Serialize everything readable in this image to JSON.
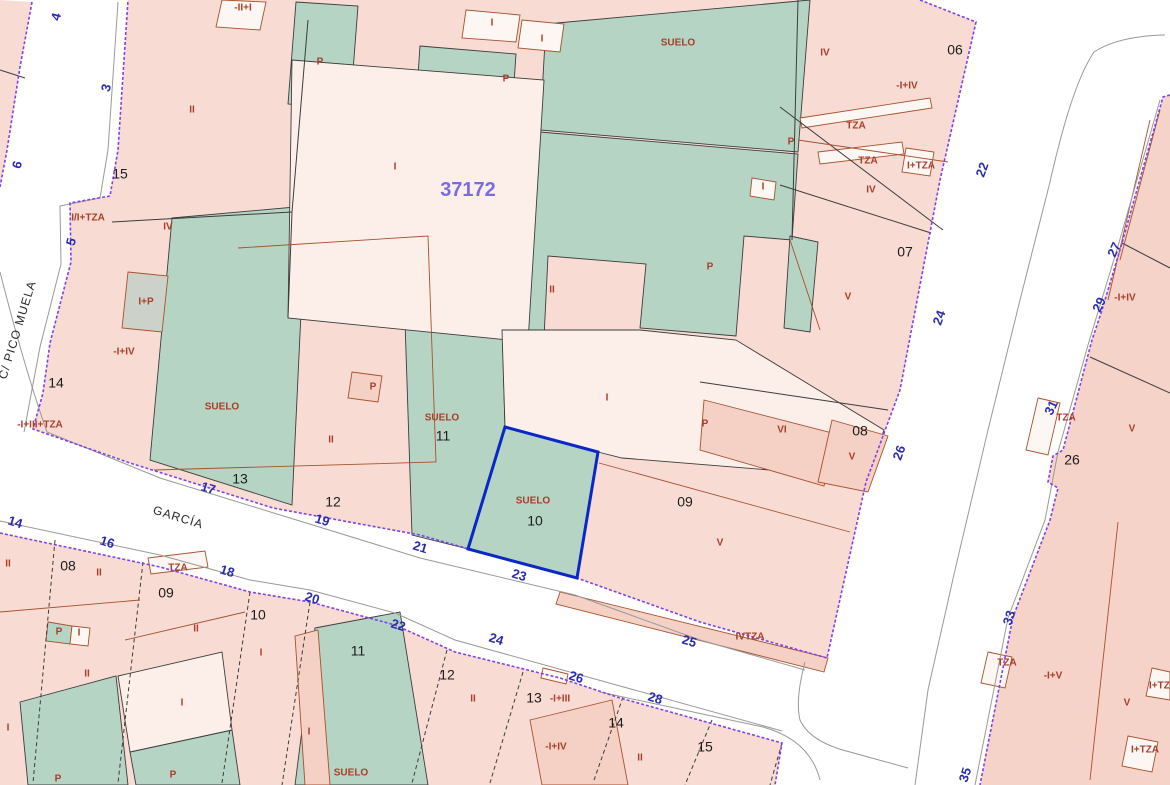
{
  "map": {
    "title": "Cadastral parcel map",
    "block_id": {
      "text": "37172",
      "x": 468,
      "y": 196
    },
    "selected_parcel": {
      "number": "10",
      "use": "SUELO"
    },
    "street_names": [
      {
        "t": "C/ PICO MUELA",
        "x": 18,
        "y": 330,
        "r": -73
      },
      {
        "t": "GARCÍA",
        "x": 178,
        "y": 518,
        "r": 17
      }
    ],
    "street_numbers": [
      {
        "t": "4",
        "x": 57,
        "y": 17,
        "r": -75
      },
      {
        "t": "3",
        "x": 107,
        "y": 88,
        "r": -75
      },
      {
        "t": "6",
        "x": 18,
        "y": 165,
        "r": -75
      },
      {
        "t": "5",
        "x": 72,
        "y": 242,
        "r": -75
      },
      {
        "t": "22",
        "x": 983,
        "y": 170,
        "r": -70
      },
      {
        "t": "24",
        "x": 940,
        "y": 318,
        "r": -70
      },
      {
        "t": "26",
        "x": 900,
        "y": 453,
        "r": -70
      },
      {
        "t": "27",
        "x": 1115,
        "y": 250,
        "r": -65
      },
      {
        "t": "29",
        "x": 1100,
        "y": 305,
        "r": -65
      },
      {
        "t": "31",
        "x": 1052,
        "y": 408,
        "r": -65
      },
      {
        "t": "33",
        "x": 1010,
        "y": 618,
        "r": -72
      },
      {
        "t": "35",
        "x": 966,
        "y": 775,
        "r": -72
      },
      {
        "t": "14",
        "x": 15,
        "y": 523,
        "r": 17
      },
      {
        "t": "16",
        "x": 107,
        "y": 543,
        "r": 17
      },
      {
        "t": "18",
        "x": 227,
        "y": 572,
        "r": 17
      },
      {
        "t": "20",
        "x": 312,
        "y": 599,
        "r": 17
      },
      {
        "t": "22",
        "x": 398,
        "y": 626,
        "r": 17
      },
      {
        "t": "24",
        "x": 496,
        "y": 640,
        "r": 17
      },
      {
        "t": "26",
        "x": 576,
        "y": 678,
        "r": 17
      },
      {
        "t": "28",
        "x": 655,
        "y": 699,
        "r": 17
      },
      {
        "t": "17",
        "x": 208,
        "y": 489,
        "r": 17
      },
      {
        "t": "19",
        "x": 322,
        "y": 521,
        "r": 17
      },
      {
        "t": "21",
        "x": 420,
        "y": 548,
        "r": 17
      },
      {
        "t": "23",
        "x": 519,
        "y": 576,
        "r": 17
      },
      {
        "t": "25",
        "x": 689,
        "y": 642,
        "r": 17
      }
    ],
    "parcel_numbers": [
      {
        "t": "15",
        "x": 120,
        "y": 175
      },
      {
        "t": "14",
        "x": 56,
        "y": 384
      },
      {
        "t": "13",
        "x": 240,
        "y": 480
      },
      {
        "t": "12",
        "x": 333,
        "y": 503
      },
      {
        "t": "11",
        "x": 443,
        "y": 437
      },
      {
        "t": "10",
        "x": 535,
        "y": 522
      },
      {
        "t": "09",
        "x": 685,
        "y": 503
      },
      {
        "t": "08",
        "x": 860,
        "y": 432
      },
      {
        "t": "07",
        "x": 905,
        "y": 253
      },
      {
        "t": "06",
        "x": 955,
        "y": 51
      },
      {
        "t": "08",
        "x": 68,
        "y": 567
      },
      {
        "t": "09",
        "x": 166,
        "y": 594
      },
      {
        "t": "10",
        "x": 258,
        "y": 616
      },
      {
        "t": "11",
        "x": 358,
        "y": 652
      },
      {
        "t": "12",
        "x": 447,
        "y": 676
      },
      {
        "t": "13",
        "x": 534,
        "y": 699
      },
      {
        "t": "14",
        "x": 616,
        "y": 724
      },
      {
        "t": "15",
        "x": 705,
        "y": 748
      },
      {
        "t": "26",
        "x": 1072,
        "y": 461
      }
    ],
    "use_labels": [
      {
        "t": "-II+I",
        "x": 243,
        "y": 8
      },
      {
        "t": "P",
        "x": 320,
        "y": 62
      },
      {
        "t": "I",
        "x": 492,
        "y": 23
      },
      {
        "t": "I",
        "x": 542,
        "y": 39
      },
      {
        "t": "P",
        "x": 506,
        "y": 79
      },
      {
        "t": "SUELO",
        "x": 678,
        "y": 43
      },
      {
        "t": "II",
        "x": 192,
        "y": 110
      },
      {
        "t": "I",
        "x": 395,
        "y": 167
      },
      {
        "t": "IV",
        "x": 825,
        "y": 53
      },
      {
        "t": "-I+IV",
        "x": 907,
        "y": 86
      },
      {
        "t": "TZA",
        "x": 856,
        "y": 126
      },
      {
        "t": "TZA",
        "x": 868,
        "y": 161
      },
      {
        "t": "I+TZA",
        "x": 921,
        "y": 166
      },
      {
        "t": "P",
        "x": 791,
        "y": 142
      },
      {
        "t": "IV",
        "x": 871,
        "y": 190
      },
      {
        "t": "I",
        "x": 763,
        "y": 187
      },
      {
        "t": "I/I+TZA",
        "x": 88,
        "y": 218
      },
      {
        "t": "IV",
        "x": 168,
        "y": 227
      },
      {
        "t": "I+P",
        "x": 146,
        "y": 302
      },
      {
        "t": "-I+IV",
        "x": 124,
        "y": 352
      },
      {
        "t": "-I+III+TZA",
        "x": 40,
        "y": 425
      },
      {
        "t": "SUELO",
        "x": 222,
        "y": 407
      },
      {
        "t": "II",
        "x": 331,
        "y": 440
      },
      {
        "t": "P",
        "x": 373,
        "y": 387
      },
      {
        "t": "II",
        "x": 552,
        "y": 290
      },
      {
        "t": "P",
        "x": 710,
        "y": 267
      },
      {
        "t": "SUELO",
        "x": 442,
        "y": 418
      },
      {
        "t": "I",
        "x": 607,
        "y": 398
      },
      {
        "t": "P",
        "x": 705,
        "y": 424
      },
      {
        "t": "VI",
        "x": 782,
        "y": 430
      },
      {
        "t": "V",
        "x": 852,
        "y": 457
      },
      {
        "t": "V",
        "x": 848,
        "y": 297
      },
      {
        "t": "SUELO",
        "x": 533,
        "y": 501
      },
      {
        "t": "V",
        "x": 720,
        "y": 543
      },
      {
        "t": "IVTZA",
        "x": 750,
        "y": 637
      },
      {
        "t": "II",
        "x": 8,
        "y": 564
      },
      {
        "t": "II",
        "x": 99,
        "y": 573
      },
      {
        "t": "TZA",
        "x": 178,
        "y": 568
      },
      {
        "t": "II",
        "x": 196,
        "y": 629
      },
      {
        "t": "P",
        "x": 59,
        "y": 632
      },
      {
        "t": "I",
        "x": 79,
        "y": 633
      },
      {
        "t": "II",
        "x": 87,
        "y": 674
      },
      {
        "t": "I",
        "x": 182,
        "y": 703
      },
      {
        "t": "I",
        "x": 8,
        "y": 728
      },
      {
        "t": "I",
        "x": 261,
        "y": 653
      },
      {
        "t": "P",
        "x": 58,
        "y": 779
      },
      {
        "t": "P",
        "x": 173,
        "y": 775
      },
      {
        "t": "I",
        "x": 309,
        "y": 732
      },
      {
        "t": "SUELO",
        "x": 351,
        "y": 773
      },
      {
        "t": "II",
        "x": 473,
        "y": 699
      },
      {
        "t": "-I+III",
        "x": 560,
        "y": 699
      },
      {
        "t": "-I+IV",
        "x": 556,
        "y": 747
      },
      {
        "t": "II",
        "x": 640,
        "y": 758
      },
      {
        "t": "-I+IV",
        "x": 1125,
        "y": 298
      },
      {
        "t": "TZA",
        "x": 1066,
        "y": 418
      },
      {
        "t": "V",
        "x": 1132,
        "y": 429
      },
      {
        "t": "TZA",
        "x": 1007,
        "y": 663
      },
      {
        "t": "-I+V",
        "x": 1053,
        "y": 676
      },
      {
        "t": "V",
        "x": 1127,
        "y": 703
      },
      {
        "t": "I+TZA",
        "x": 1145,
        "y": 750
      },
      {
        "t": "I+TZA",
        "x": 1163,
        "y": 686
      }
    ],
    "colors": {
      "parcel_pink": "#f8dcd3",
      "parcel_pink_dark": "#f4d0c5",
      "parcel_light": "#fcefe9",
      "parcel_green": "#b6d4c3",
      "use_label_red": "#a93e2b",
      "street_number_blue": "#2b2bb0",
      "parcel_number_black": "#1c1c1c",
      "block_boundary_purple": "#7f42e6",
      "selected_outline_blue": "#0a28c8",
      "block_id_purple": "#7a6ce0"
    }
  }
}
